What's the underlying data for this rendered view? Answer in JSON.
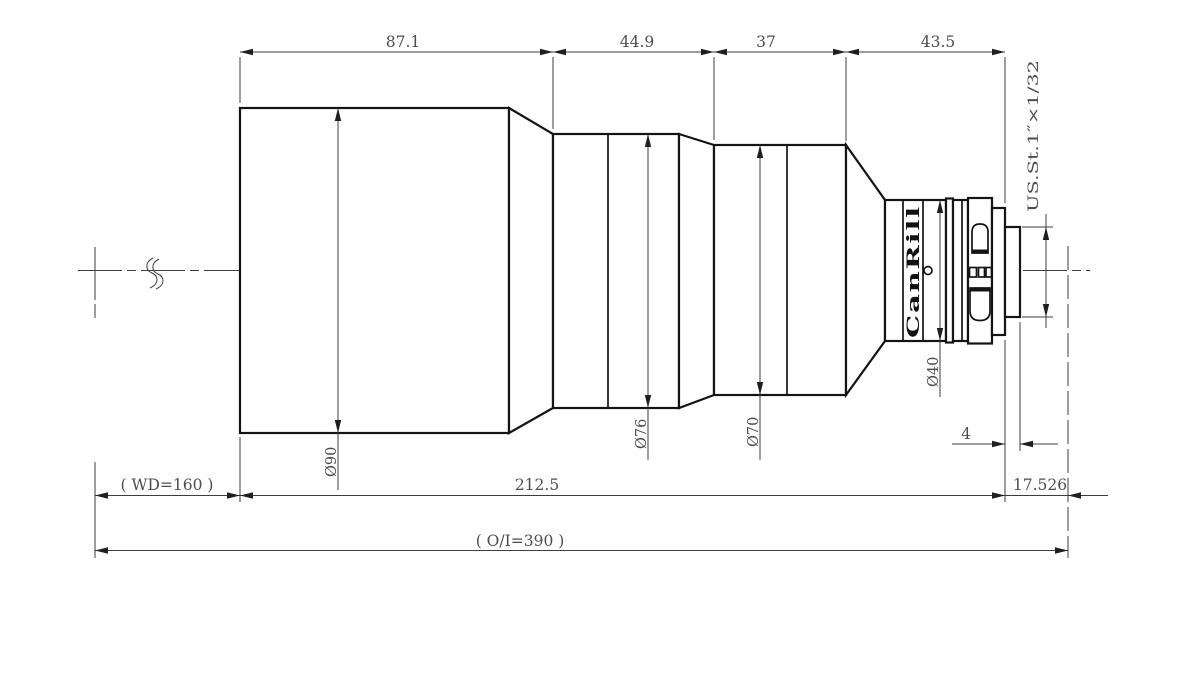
{
  "meta": {
    "description": "Dimensioned engineering side-view drawing of a machine-vision lens",
    "background_color": "#ffffff",
    "outline_color": "#141414",
    "dimension_color": "#3d3d3d",
    "text_color": "#4d4d4d"
  },
  "dims": {
    "seg1": "87.1",
    "seg2": "44.9",
    "seg3": "37",
    "seg4": "43.5",
    "dia90": "Ø90",
    "dia76": "Ø76",
    "dia70": "Ø70",
    "dia40": "Ø40",
    "thread": "US.St.1″×1/32",
    "len4": "4",
    "wd": "( WD=160 )",
    "total": "212.5",
    "ffd": "17.526",
    "oi": "( O/I=390 )"
  },
  "brand": "CanRill"
}
